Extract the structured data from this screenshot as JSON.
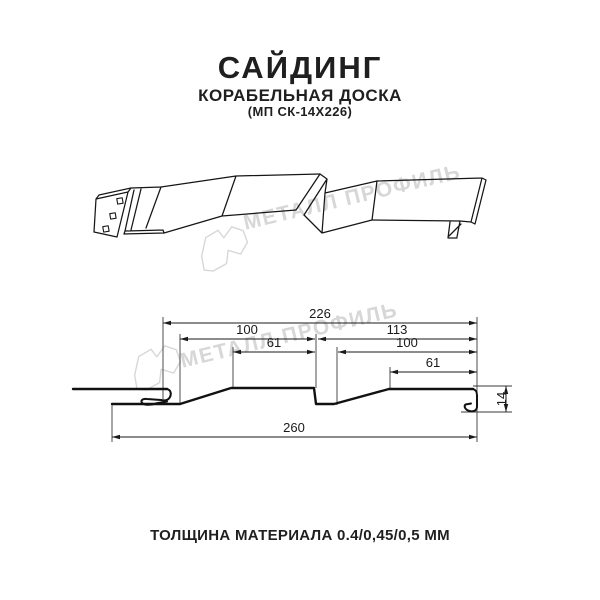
{
  "product": {
    "title": "САЙДИНГ",
    "subtitle": "КОРАБЕЛЬНАЯ ДОСКА",
    "code": "(МП СК-14Х226)"
  },
  "watermark": {
    "text": "МЕТАЛЛ ПРОФИЛЬ"
  },
  "dimensions": {
    "top_width": "226",
    "left_board_width": "100",
    "right_board_width": "113",
    "left_board_face": "61",
    "right_board_inner": "100",
    "right_board_face": "61",
    "overall_width": "260",
    "profile_height": "14"
  },
  "footer": {
    "thickness_label": "ТОЛЩИНА МАТЕРИАЛА 0.4/0,45/0,5 ММ"
  },
  "colors": {
    "line": "#1a1a1a",
    "watermark": "#d7d7d7",
    "background": "#ffffff"
  }
}
